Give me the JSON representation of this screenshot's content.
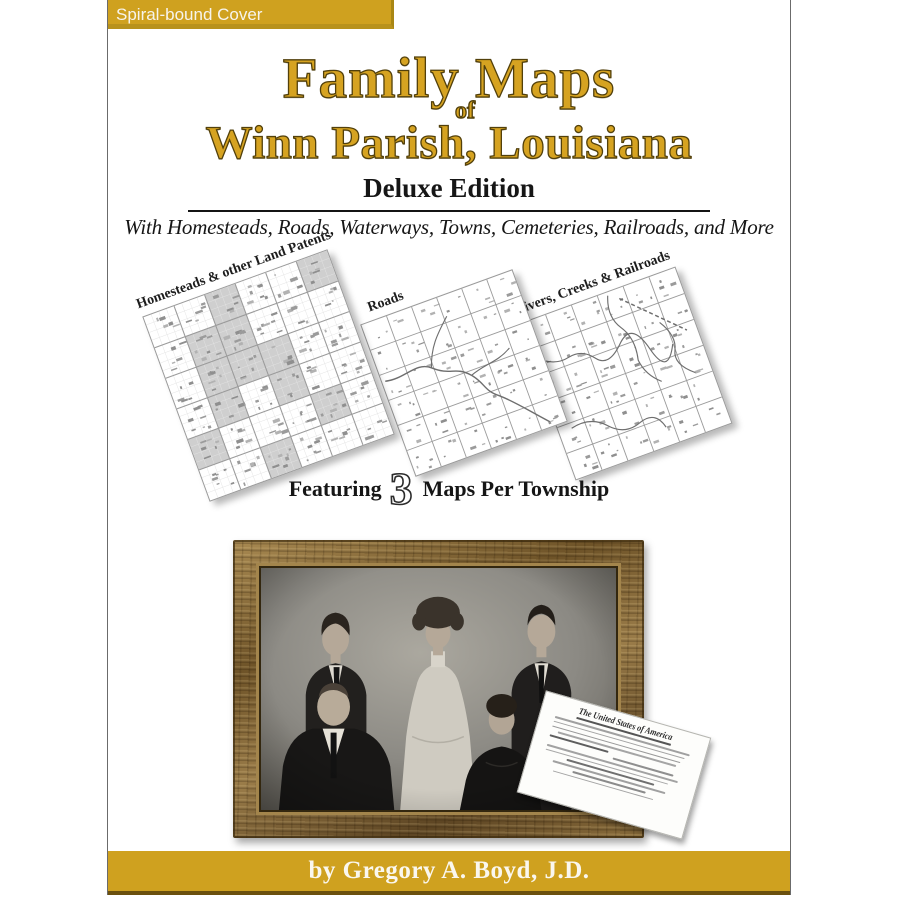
{
  "colors": {
    "gold": "#CFA11F",
    "gold_dark": "#6b500e",
    "title_gold": "#D6A321",
    "title_outline": "#52400B",
    "ink": "#161616"
  },
  "top_label": {
    "text": "Spiral-bound Cover"
  },
  "title": {
    "line1": "Family Maps",
    "of": "of",
    "line2": "Winn Parish, Louisiana",
    "edition": "Deluxe Edition",
    "subtitle": "With Homesteads, Roads, Waterways, Towns, Cemeteries, Railroads, and More"
  },
  "maps": [
    {
      "label": "Homesteads & other Land Patents"
    },
    {
      "label": "Roads"
    },
    {
      "label": "Rivers, Creeks & Railroads"
    }
  ],
  "featuring": {
    "prefix": "Featuring",
    "number": "3",
    "suffix": "Maps Per Township"
  },
  "document": {
    "title": "The United States of America"
  },
  "author": {
    "text": "by Gregory A. Boyd, J.D."
  }
}
